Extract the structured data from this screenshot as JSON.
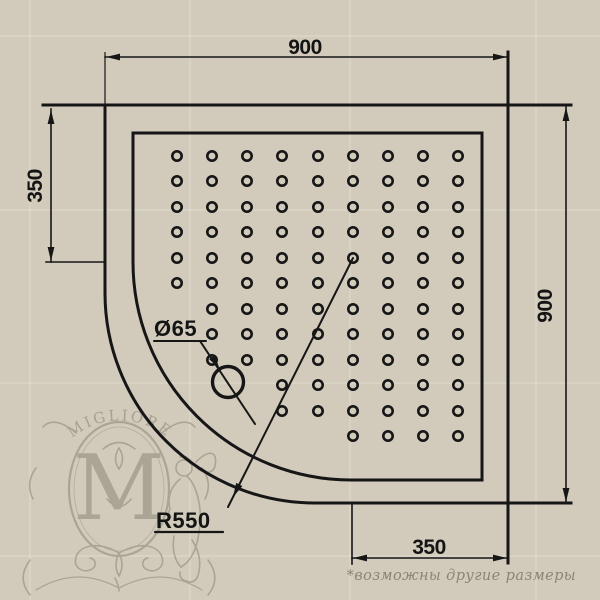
{
  "drawing": {
    "dimensions": {
      "width_top": "900",
      "height_right": "900",
      "offset_left": "350",
      "offset_bottom": "350",
      "drain_diameter": "Ø65",
      "corner_radius": "R550"
    },
    "watermark": {
      "brand": "MIGLIORE",
      "monogram": "M"
    },
    "footnote": "*возможны другие размеры",
    "colors": {
      "background": "#d2cbbc",
      "line": "#161616",
      "watermark": "#a09a8b",
      "footnote": "#8b8578"
    }
  },
  "dot_pattern": {
    "radius": 4.7,
    "rows": [
      {
        "y": 156,
        "x": [
          177,
          212,
          247,
          282,
          318,
          353,
          388,
          423,
          458
        ]
      },
      {
        "y": 181,
        "x": [
          177,
          212,
          247,
          282,
          318,
          353,
          388,
          423,
          458
        ]
      },
      {
        "y": 207,
        "x": [
          177,
          212,
          247,
          282,
          318,
          353,
          388,
          423,
          458
        ]
      },
      {
        "y": 232,
        "x": [
          177,
          212,
          247,
          282,
          318,
          353,
          388,
          423,
          458
        ]
      },
      {
        "y": 258,
        "x": [
          177,
          212,
          247,
          282,
          318,
          353,
          388,
          423,
          458
        ]
      },
      {
        "y": 283,
        "x": [
          177,
          212,
          247,
          282,
          318,
          353,
          388,
          423,
          458
        ]
      },
      {
        "y": 309,
        "x": [
          212,
          247,
          282,
          318,
          353,
          388,
          423,
          458
        ]
      },
      {
        "y": 334,
        "x": [
          212,
          247,
          282,
          318,
          353,
          388,
          423,
          458
        ]
      },
      {
        "y": 360,
        "x": [
          212,
          247,
          282,
          318,
          353,
          388,
          423,
          458
        ]
      },
      {
        "y": 385,
        "x": [
          282,
          318,
          353,
          388,
          423,
          458
        ]
      },
      {
        "y": 411,
        "x": [
          282,
          318,
          353,
          388,
          423,
          458
        ]
      },
      {
        "y": 436,
        "x": [
          353,
          388,
          423,
          458
        ]
      }
    ]
  }
}
